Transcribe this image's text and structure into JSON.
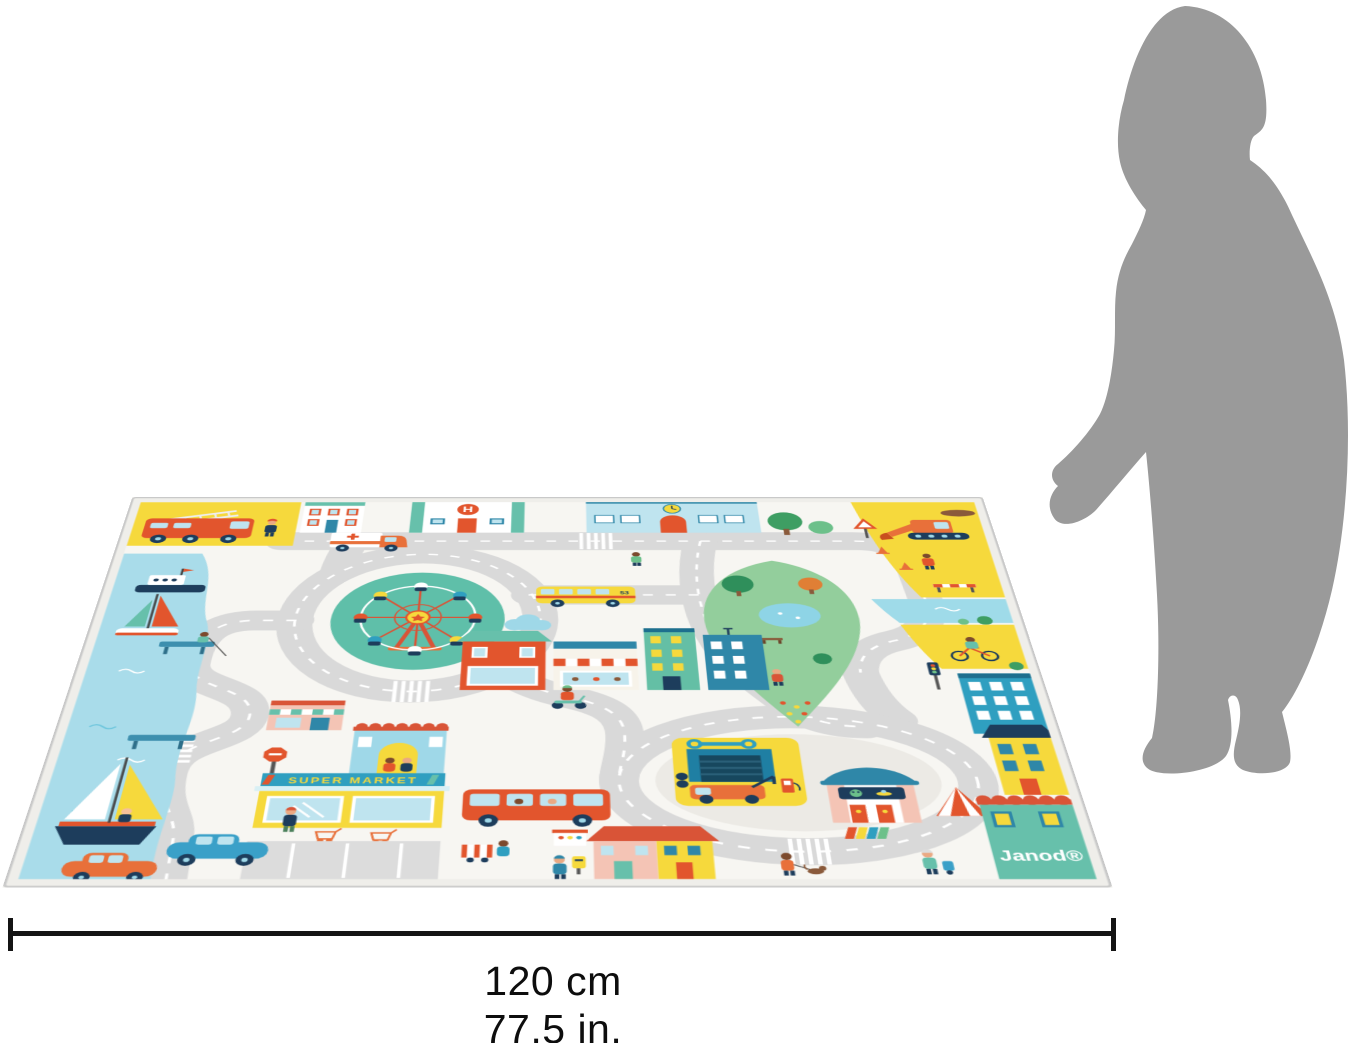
{
  "dimension_label": {
    "cm": "120 cm",
    "inches": "77,5 in."
  },
  "mat": {
    "brand": "Janod®",
    "supermarket_sign": "SUPER MARKET",
    "hospital_letter": "H",
    "school_bus_number": "53",
    "colors": {
      "road": "#d9d9d9",
      "mat_background": "#f7f6f2",
      "water": "#a9dcea",
      "park_green": "#93ce9c",
      "roundabout_teal": "#5fbfa9",
      "accent_yellow": "#f6d93c",
      "accent_red": "#e2552d",
      "accent_blue": "#2f9fc0",
      "accent_pink": "#f4c4b5",
      "navy": "#1d3d5c",
      "silhouette_gray": "#9a9a9a"
    }
  },
  "scale_reference": {
    "figure": "child-silhouette"
  }
}
